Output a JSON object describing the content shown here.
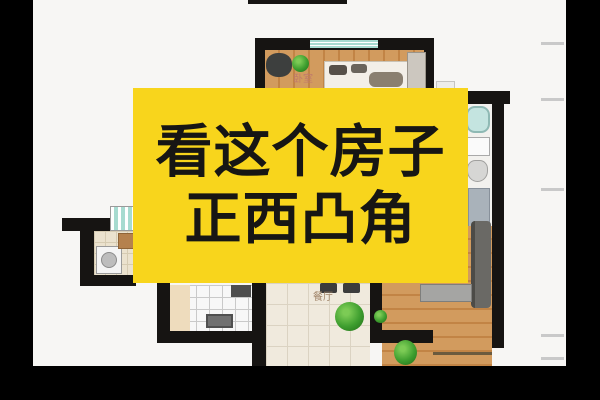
{
  "overlay": {
    "line1": "看这个房子",
    "line2": "正西凸角"
  },
  "floorplan": {
    "bedroom_label": "卧室",
    "dining_label": "餐厅"
  },
  "colors": {
    "overlay-bg": "#F8D51C",
    "overlay-text": "#171614",
    "frame-bar": "#000000",
    "canvas-bg": "#F7F6F4",
    "wall": "#161412",
    "wood": "#D29B5E",
    "wood-stripe": "#C28445",
    "tile": "#F0EADD",
    "tile-line": "#DBD3C2",
    "bath-tile": "#F7F7F7",
    "bath-tile-line": "#C9C9C9",
    "kitchen-tile": "#EBE2CE",
    "kitchen-tile-line": "#D6CBB2",
    "window": "#A7DBD0",
    "plant": "#3E9E2F",
    "tick": "#C9C9C9",
    "bedroom-label-color": "#C07A6B",
    "dining-label-color": "#A08468"
  }
}
